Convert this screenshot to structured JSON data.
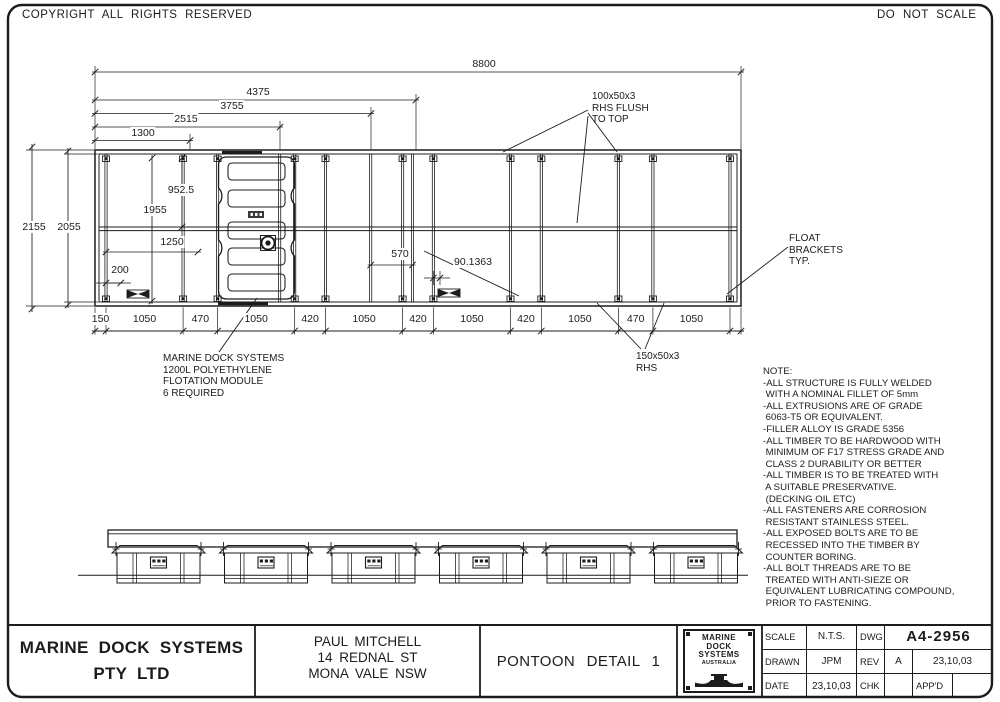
{
  "sheet": {
    "copyright": "COPYRIGHT ALL RIGHTS RESERVED",
    "do_not_scale": "DO NOT SCALE"
  },
  "plan_view": {
    "dims": {
      "overall_length": "8800",
      "len_4375": "4375",
      "len_3755": "3755",
      "len_2515": "2515",
      "len_1300": "1300",
      "overall_width": "2155",
      "inner_width": "2055",
      "w_952_5": "952.5",
      "w_1955": "1955",
      "w_1250": "1250",
      "w_200": "200",
      "w_570": "570",
      "w_90": "90.1363"
    },
    "bottom_dims": [
      "150",
      "1050",
      "470",
      "1050",
      "420",
      "1050",
      "420",
      "1050",
      "420",
      "1050",
      "470",
      "1050"
    ],
    "labels": {
      "rhs_top": "100x50x3\nRHS FLUSH\nTO TOP",
      "float_brackets": "FLOAT\nBRACKETS\nTYP.",
      "rhs_bottom": "150x50x3\nRHS",
      "flotation_module": "MARINE DOCK SYSTEMS\n1200L POLYETHYLENE\nFLOTATION MODULE\n6 REQUIRED"
    }
  },
  "notes": {
    "title": "NOTE:",
    "items": [
      "-ALL STRUCTURE IS FULLY WELDED\n WITH A NOMINAL FILLET OF 5mm",
      "-ALL EXTRUSIONS ARE OF GRADE\n 6063-T5 OR EQUIVALENT.",
      "-FILLER ALLOY IS GRADE 5356",
      "-ALL TIMBER TO BE HARDWOOD WITH\n MINIMUM OF F17 STRESS GRADE AND\n CLASS 2 DURABILITY OR BETTER",
      "-ALL TIMBER IS TO BE TREATED WITH\n A SUITABLE PRESERVATIVE.\n (DECKING OIL ETC)",
      "-ALL FASTENERS ARE CORROSION\n RESISTANT STAINLESS STEEL.",
      "-ALL EXPOSED BOLTS ARE TO BE\n RECESSED INTO THE TIMBER BY\n COUNTER BORING.",
      "-ALL BOLT THREADS ARE TO BE\n TREATED WITH ANTI-SIEZE OR\n EQUIVALENT LUBRICATING COMPOUND,\n PRIOR TO FASTENING."
    ]
  },
  "title_block": {
    "company": "MARINE DOCK SYSTEMS\nPTY LTD",
    "client": [
      "PAUL MITCHELL",
      "14 REDNAL ST",
      "MONA VALE NSW"
    ],
    "drawing_title": "PONTOON DETAIL 1",
    "logo_lines": [
      "MARINE",
      "DOCK",
      "SYSTEMS",
      "AUSTRALIA"
    ],
    "fields": {
      "scale_label": "SCALE",
      "scale": "N.T.S.",
      "dwg_label": "DWG",
      "dwg_no": "A4-2956",
      "drawn_label": "DRAWN",
      "drawn": "JPM",
      "rev_label": "REV",
      "rev": "A",
      "rev_date": "23,10,03",
      "date_label": "DATE",
      "date": "23,10,03",
      "chk_label": "CHK",
      "appd_label": "APP'D"
    }
  }
}
